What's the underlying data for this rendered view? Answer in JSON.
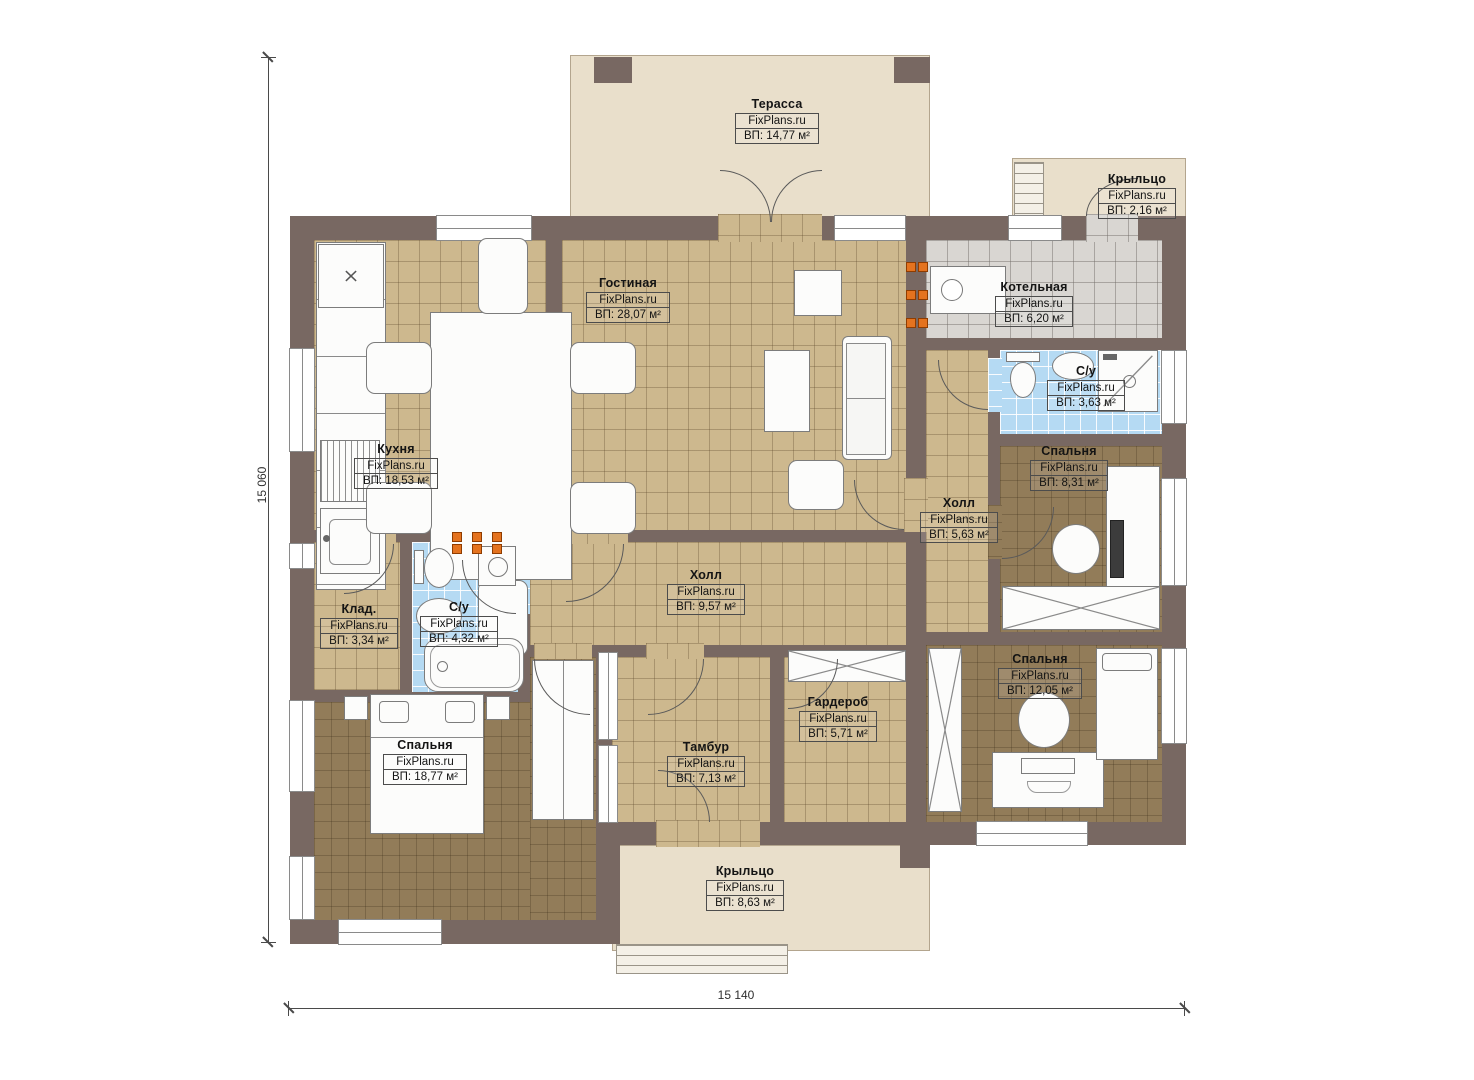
{
  "brand": "FixPlans.ru",
  "dimensions": {
    "height": "15 060",
    "width": "15 140"
  },
  "rooms": [
    {
      "name": "Терасса",
      "area": "ВП: 14,77 м²"
    },
    {
      "name": "Крыльцо",
      "area": "ВП: 2,16 м²"
    },
    {
      "name": "Гостиная",
      "area": "ВП: 28,07 м²"
    },
    {
      "name": "Котельная",
      "area": "ВП: 6,20 м²"
    },
    {
      "name": "С/у",
      "area": "ВП: 3,63 м²"
    },
    {
      "name": "Кухня",
      "area": "ВП: 18,53 м²"
    },
    {
      "name": "Спальня",
      "area": "ВП: 8,31 м²"
    },
    {
      "name": "Холл",
      "area": "ВП: 5,63 м²"
    },
    {
      "name": "Холл",
      "area": "ВП: 9,57 м²"
    },
    {
      "name": "Клад.",
      "area": "ВП: 3,34 м²"
    },
    {
      "name": "С/у",
      "area": "ВП: 4,32 м²"
    },
    {
      "name": "Гардероб",
      "area": "ВП: 5,71 м²"
    },
    {
      "name": "Тамбур",
      "area": "ВП: 7,13 м²"
    },
    {
      "name": "Спальня",
      "area": "ВП: 12,05 м²"
    },
    {
      "name": "Спальня",
      "area": "ВП: 18,77 м²"
    },
    {
      "name": "Крыльцо",
      "area": "ВП: 8,63 м²"
    }
  ],
  "palette": {
    "wall": "#786862",
    "floor_tan": "#cdb88e",
    "floor_dark": "#927c59",
    "tile_blue": "#b5daf3",
    "tile_gray": "#d9d6d2",
    "terrace_beige": "#e9dfcb",
    "radiator_orange": "#e4731f"
  }
}
